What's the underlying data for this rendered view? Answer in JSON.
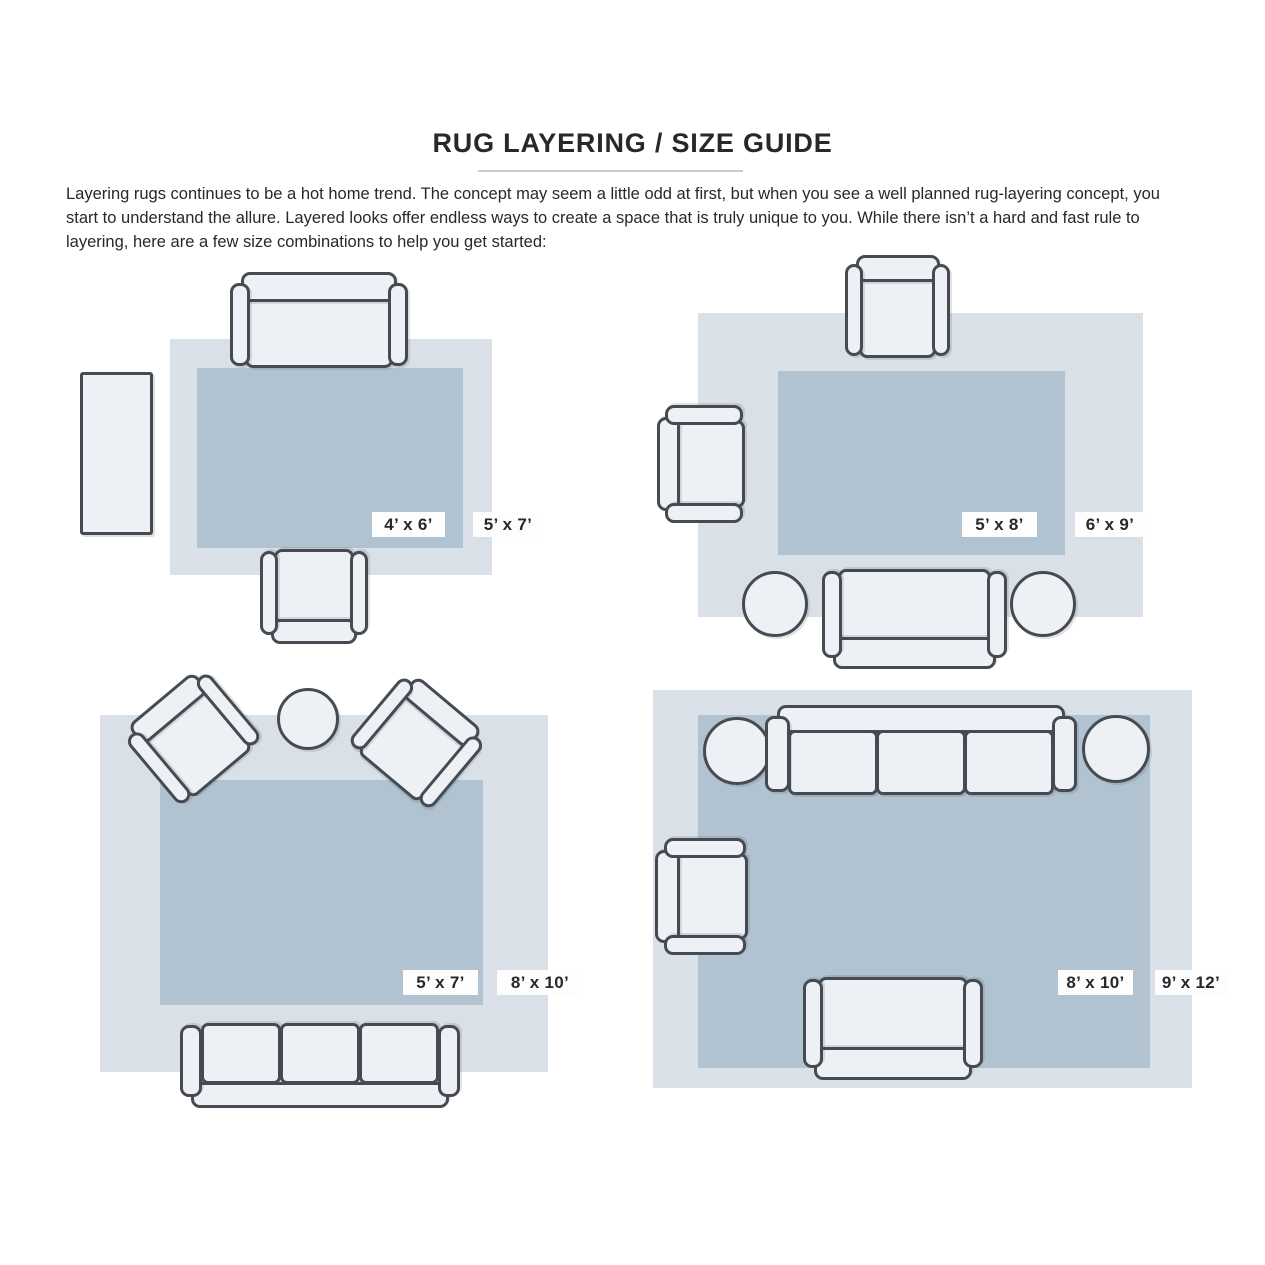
{
  "page": {
    "title": "RUG LAYERING / SIZE GUIDE",
    "intro": "Layering rugs continues to be a hot home trend. The concept may seem a little odd at first, but when you see a well planned rug-layering concept, you start to understand the allure. Layered looks offer endless ways to create a space that is truly unique to you. While there isn’t a hard and fast rule to layering, here are a few size combinations to help you get started:"
  },
  "palette": {
    "large_rug": "#d9e0e7",
    "small_rug": "#b1c3d1",
    "furniture_fill": "#edf1f5",
    "outline": "#464b51",
    "text": "#26282b"
  },
  "scenes": [
    {
      "name": "top-left",
      "small_rug": "4’ x 6’",
      "large_rug": "5’ x 7’",
      "furniture": [
        "loveseat-sofa",
        "armchair",
        "runner-rug"
      ]
    },
    {
      "name": "top-right",
      "small_rug": "5’ x 8’",
      "large_rug": "6’ x 9’",
      "furniture": [
        "armchair-top",
        "armchair-left",
        "sofa",
        "round-ottoman-left",
        "round-ottoman-right"
      ]
    },
    {
      "name": "bottom-left",
      "small_rug": "5’ x 7’",
      "large_rug": "8’ x 10’",
      "furniture": [
        "angled-armchair-left",
        "angled-armchair-right",
        "round-table",
        "three-seat-sofa"
      ]
    },
    {
      "name": "bottom-right",
      "small_rug": "8’ x 10’",
      "large_rug": "9’ x 12’",
      "furniture": [
        "three-seat-sofa",
        "armchair-left",
        "loveseat",
        "round-ottoman-left",
        "round-ottoman-right"
      ]
    }
  ]
}
